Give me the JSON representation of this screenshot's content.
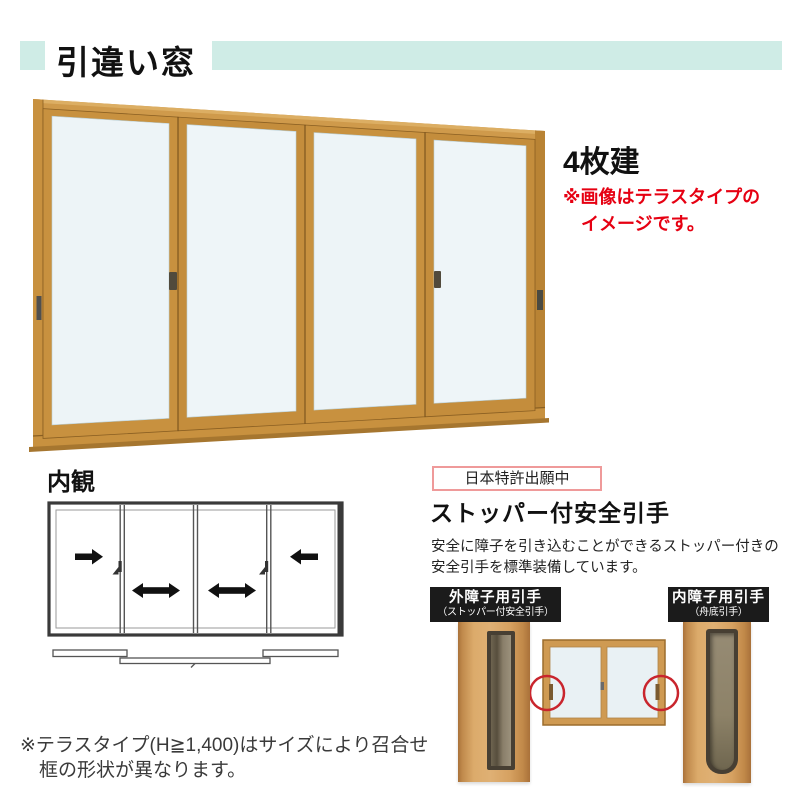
{
  "header": {
    "title": "引違い窓",
    "accent_color": "#cfece6"
  },
  "main_product": {
    "image_alt": "4-panel-sliding-window-gold-frame",
    "panel_count_label": "4枚建",
    "terrace_note_line1": "※画像はテラスタイプの",
    "terrace_note_line2": "イメージです。",
    "note_color": "#e60012",
    "frame_color": "#c8913f",
    "glass_color": "#edf4f7"
  },
  "interior": {
    "label": "内観",
    "icons": [
      "slide-right-arrow",
      "slide-both-arrow",
      "slide-both-arrow",
      "slide-left-arrow",
      "crescent-lock",
      "crescent-lock"
    ]
  },
  "feature": {
    "patent_badge": "日本特許出願中",
    "heading": "ストッパー付安全引手",
    "desc_line1": "安全に障子を引き込むことができるストッパー付きの",
    "desc_line2": "安全引手を標準装備しています。",
    "outer_handle": {
      "title": "外障子用引手",
      "subtitle": "（ストッパー付安全引手）"
    },
    "inner_handle": {
      "title": "内障子用引手",
      "subtitle": "（舟底引手）"
    },
    "highlight_circle_color": "#c9252d",
    "label_bg_color": "#1b1b1b"
  },
  "footnote": {
    "line1": "※テラスタイプ(H≧1,400)はサイズにより召合せ",
    "line2": "框の形状が異なります。"
  }
}
